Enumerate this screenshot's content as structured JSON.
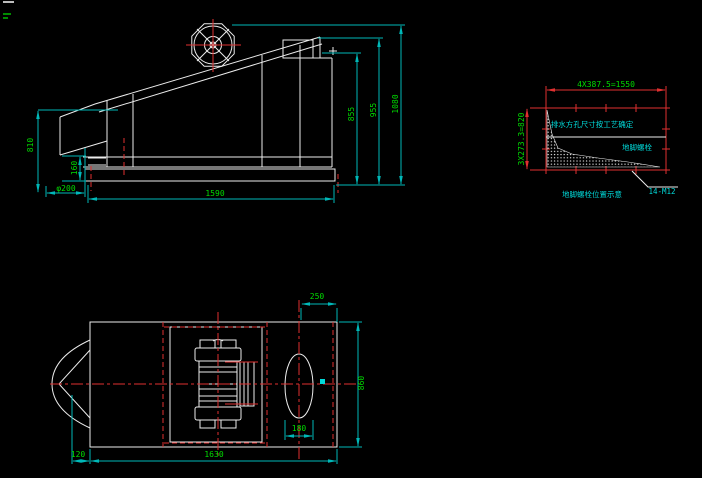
{
  "colors": {
    "background": "#000000",
    "geometry": "#ececec",
    "dimension_line": "#00b8b8",
    "dimension_text": "#00dd00",
    "centerline_red": "#e03030",
    "annotation_cyan": "#00d8d8"
  },
  "side_view": {
    "dims": {
      "feed_height": "810",
      "base_gap": "160",
      "spout_diameter": "φ200",
      "overall_length": "1590",
      "body_height": "855",
      "mid_height": "955",
      "overall_height": "1080"
    }
  },
  "foundation_view": {
    "dims": {
      "bolt_spacing_horizontal": "4X387.5=1550",
      "bolt_spacing_vertical": "3X273.3=820",
      "bolt_spec": "14-M12"
    },
    "notes": {
      "drain_note": "排水方孔尺寸按工艺确定",
      "anchor_label": "地脚螺栓",
      "caption": "地脚螺栓位置示意"
    }
  },
  "plan_view": {
    "dims": {
      "discharge_offset": "250",
      "hole_width": "180",
      "overall_width": "860",
      "tail_length": "120",
      "overall_length": "1630"
    }
  }
}
